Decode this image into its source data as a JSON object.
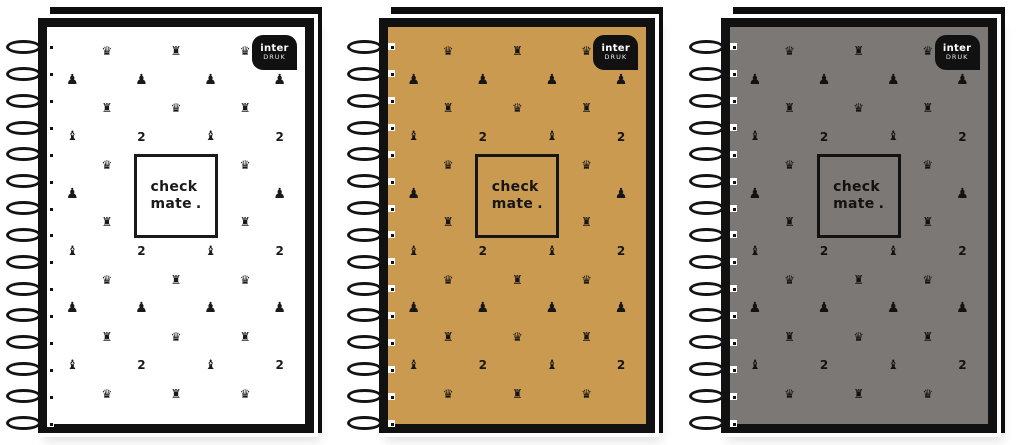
{
  "shelf": {
    "brand_logo": {
      "line1": "inter",
      "line2": "DRUK"
    },
    "center_label": {
      "line1": "check",
      "line2": "mate",
      "period": "."
    },
    "icon_glyphs": {
      "queen": "♛",
      "rook": "♜",
      "pawn": "♟",
      "bishop": "♝",
      "knight": "2"
    },
    "pattern_rows": [
      [
        "",
        "queen",
        "",
        "rook",
        "",
        "queen",
        ""
      ],
      [
        "pawn",
        "",
        "pawn",
        "",
        "pawn",
        "",
        "pawn"
      ],
      [
        "",
        "rook",
        "",
        "queen",
        "",
        "rook",
        ""
      ],
      [
        "bishop",
        "",
        "knight",
        "",
        "bishop",
        "",
        "knight"
      ],
      [
        "",
        "queen",
        "",
        "",
        "",
        "queen",
        ""
      ],
      [
        "pawn",
        "",
        "",
        "",
        "",
        "",
        "pawn"
      ],
      [
        "",
        "rook",
        "",
        "",
        "",
        "rook",
        ""
      ],
      [
        "bishop",
        "",
        "knight",
        "",
        "bishop",
        "",
        "knight"
      ],
      [
        "",
        "queen",
        "",
        "rook",
        "",
        "queen",
        ""
      ],
      [
        "pawn",
        "",
        "pawn",
        "",
        "pawn",
        "",
        "pawn"
      ],
      [
        "",
        "rook",
        "",
        "queen",
        "",
        "rook",
        ""
      ],
      [
        "bishop",
        "",
        "knight",
        "",
        "bishop",
        "",
        "knight"
      ],
      [
        "",
        "queen",
        "",
        "rook",
        "",
        "queen",
        ""
      ]
    ],
    "spiral_coil_count": 15,
    "notebooks": [
      {
        "name": "notebook-white",
        "cover_color": "#ffffff",
        "icon_color": "#1a1a1a"
      },
      {
        "name": "notebook-gold",
        "cover_color": "#c99a50",
        "icon_color": "#161616"
      },
      {
        "name": "notebook-gray",
        "cover_color": "#7b7875",
        "icon_color": "#121212"
      }
    ],
    "colors": {
      "cover_outline": "#111111",
      "back_cover": "#0d0d0d",
      "logo_bg": "#111111",
      "logo_text": "#ffffff",
      "background": "#ffffff"
    }
  }
}
